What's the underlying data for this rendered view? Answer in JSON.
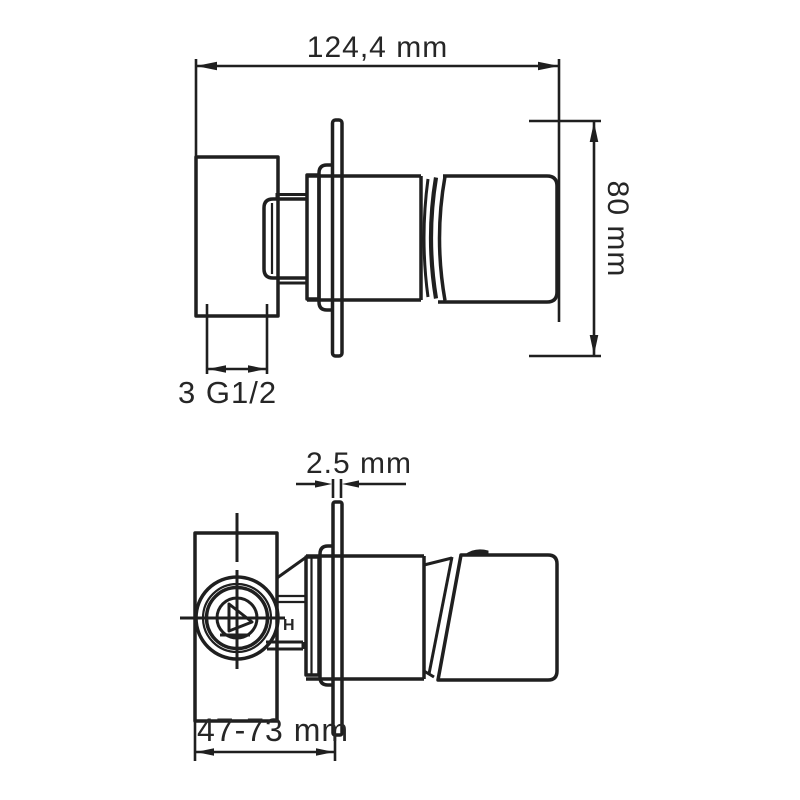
{
  "page": {
    "colors": {
      "line": "#1f1f1f",
      "text": "#262626",
      "background": "#ffffff"
    }
  },
  "drawing": {
    "front_view": {
      "width_dimension": "124,4 mm",
      "height_dimension": "80 mm",
      "thread_label": "3 G1/2"
    },
    "side_view": {
      "plate_thickness_dimension": "2.5 mm",
      "mounting_depth_dimension": "47-73 mm",
      "hot_marking": "H"
    }
  }
}
